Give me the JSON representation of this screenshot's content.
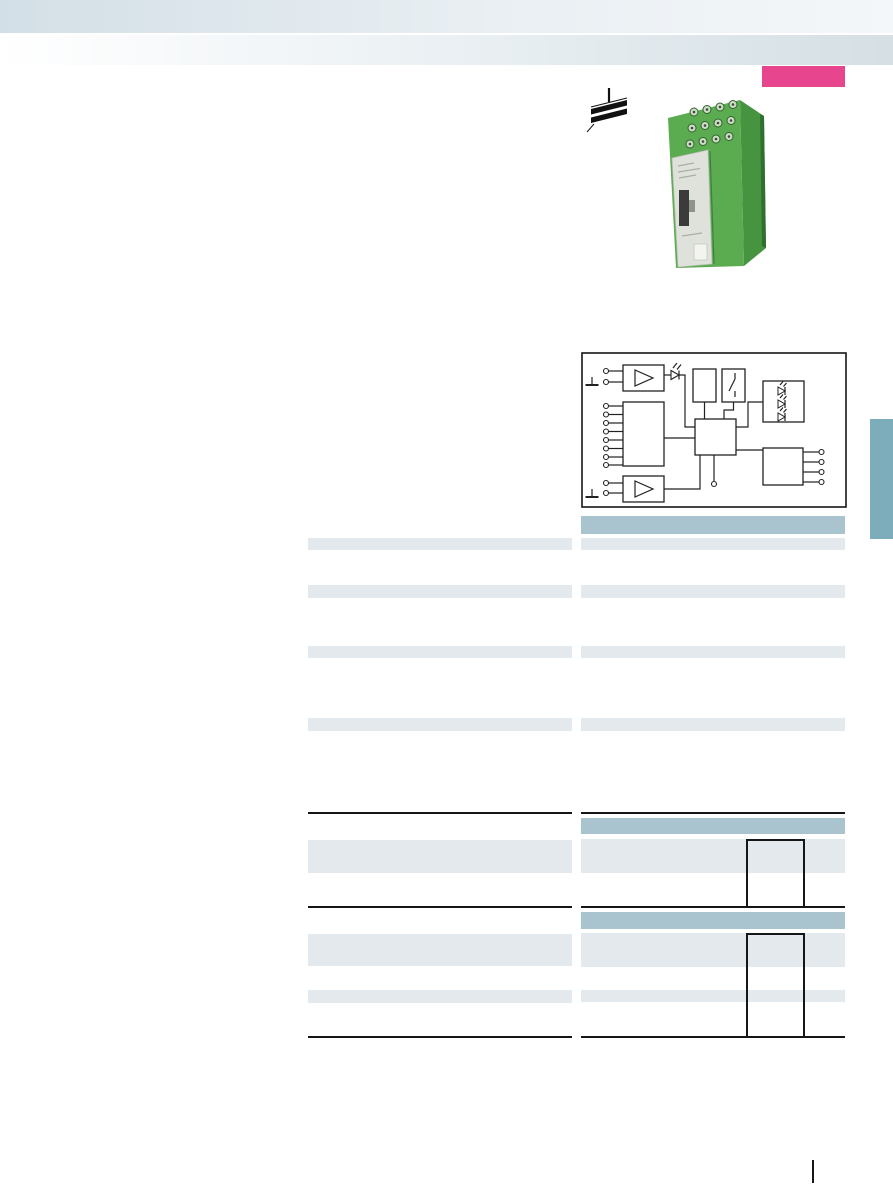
{
  "colors": {
    "page_bg": "#ffffff",
    "band1_left": "#d3dfe6",
    "band2_left": "#ffffff",
    "band2_right": "#d5dfe4",
    "badge": "#e8458f",
    "tab": "#7dacba",
    "table_header": "#a9c4ce",
    "table_row": "#e3e9ec",
    "rule": "#161616",
    "diagram_stroke": "#222222",
    "module_green": "#5bab51",
    "module_green_side": "#46943f",
    "module_label": "#dfe2db"
  },
  "header": {
    "gradient_bands": 2
  },
  "badge": {
    "kind": "highlight-color-block"
  },
  "product": {
    "kind": "green-din-rail-module-photo",
    "din_rail_icon": "din-rail-mounting-icon"
  },
  "diagram": {
    "kind": "block-circuit-diagram",
    "blocks": [
      "input-amplifier-top",
      "multichannel-input-block",
      "input-amplifier-bottom",
      "power-supply-block",
      "switch-block",
      "central-controller",
      "led-indicator-block",
      "output-terminal-block"
    ],
    "led_symbols": 4,
    "terminals_left_top": 2,
    "terminals_left_middle": 8,
    "terminals_left_bottom": 2,
    "terminals_right": 4,
    "terminals_bottom": 1,
    "ground_symbols": 2
  },
  "spec_table": {
    "columns": 2,
    "right_header_bars": 1,
    "row_stripes_per_column": 4
  },
  "bottom_tables": {
    "sections": 2,
    "right_header_bars_per_section": 1,
    "pulse_timing_diagrams": 2,
    "tall_row_stripes": 2,
    "short_row_stripes": 2
  },
  "footer": {
    "page_marker_separator": true
  }
}
